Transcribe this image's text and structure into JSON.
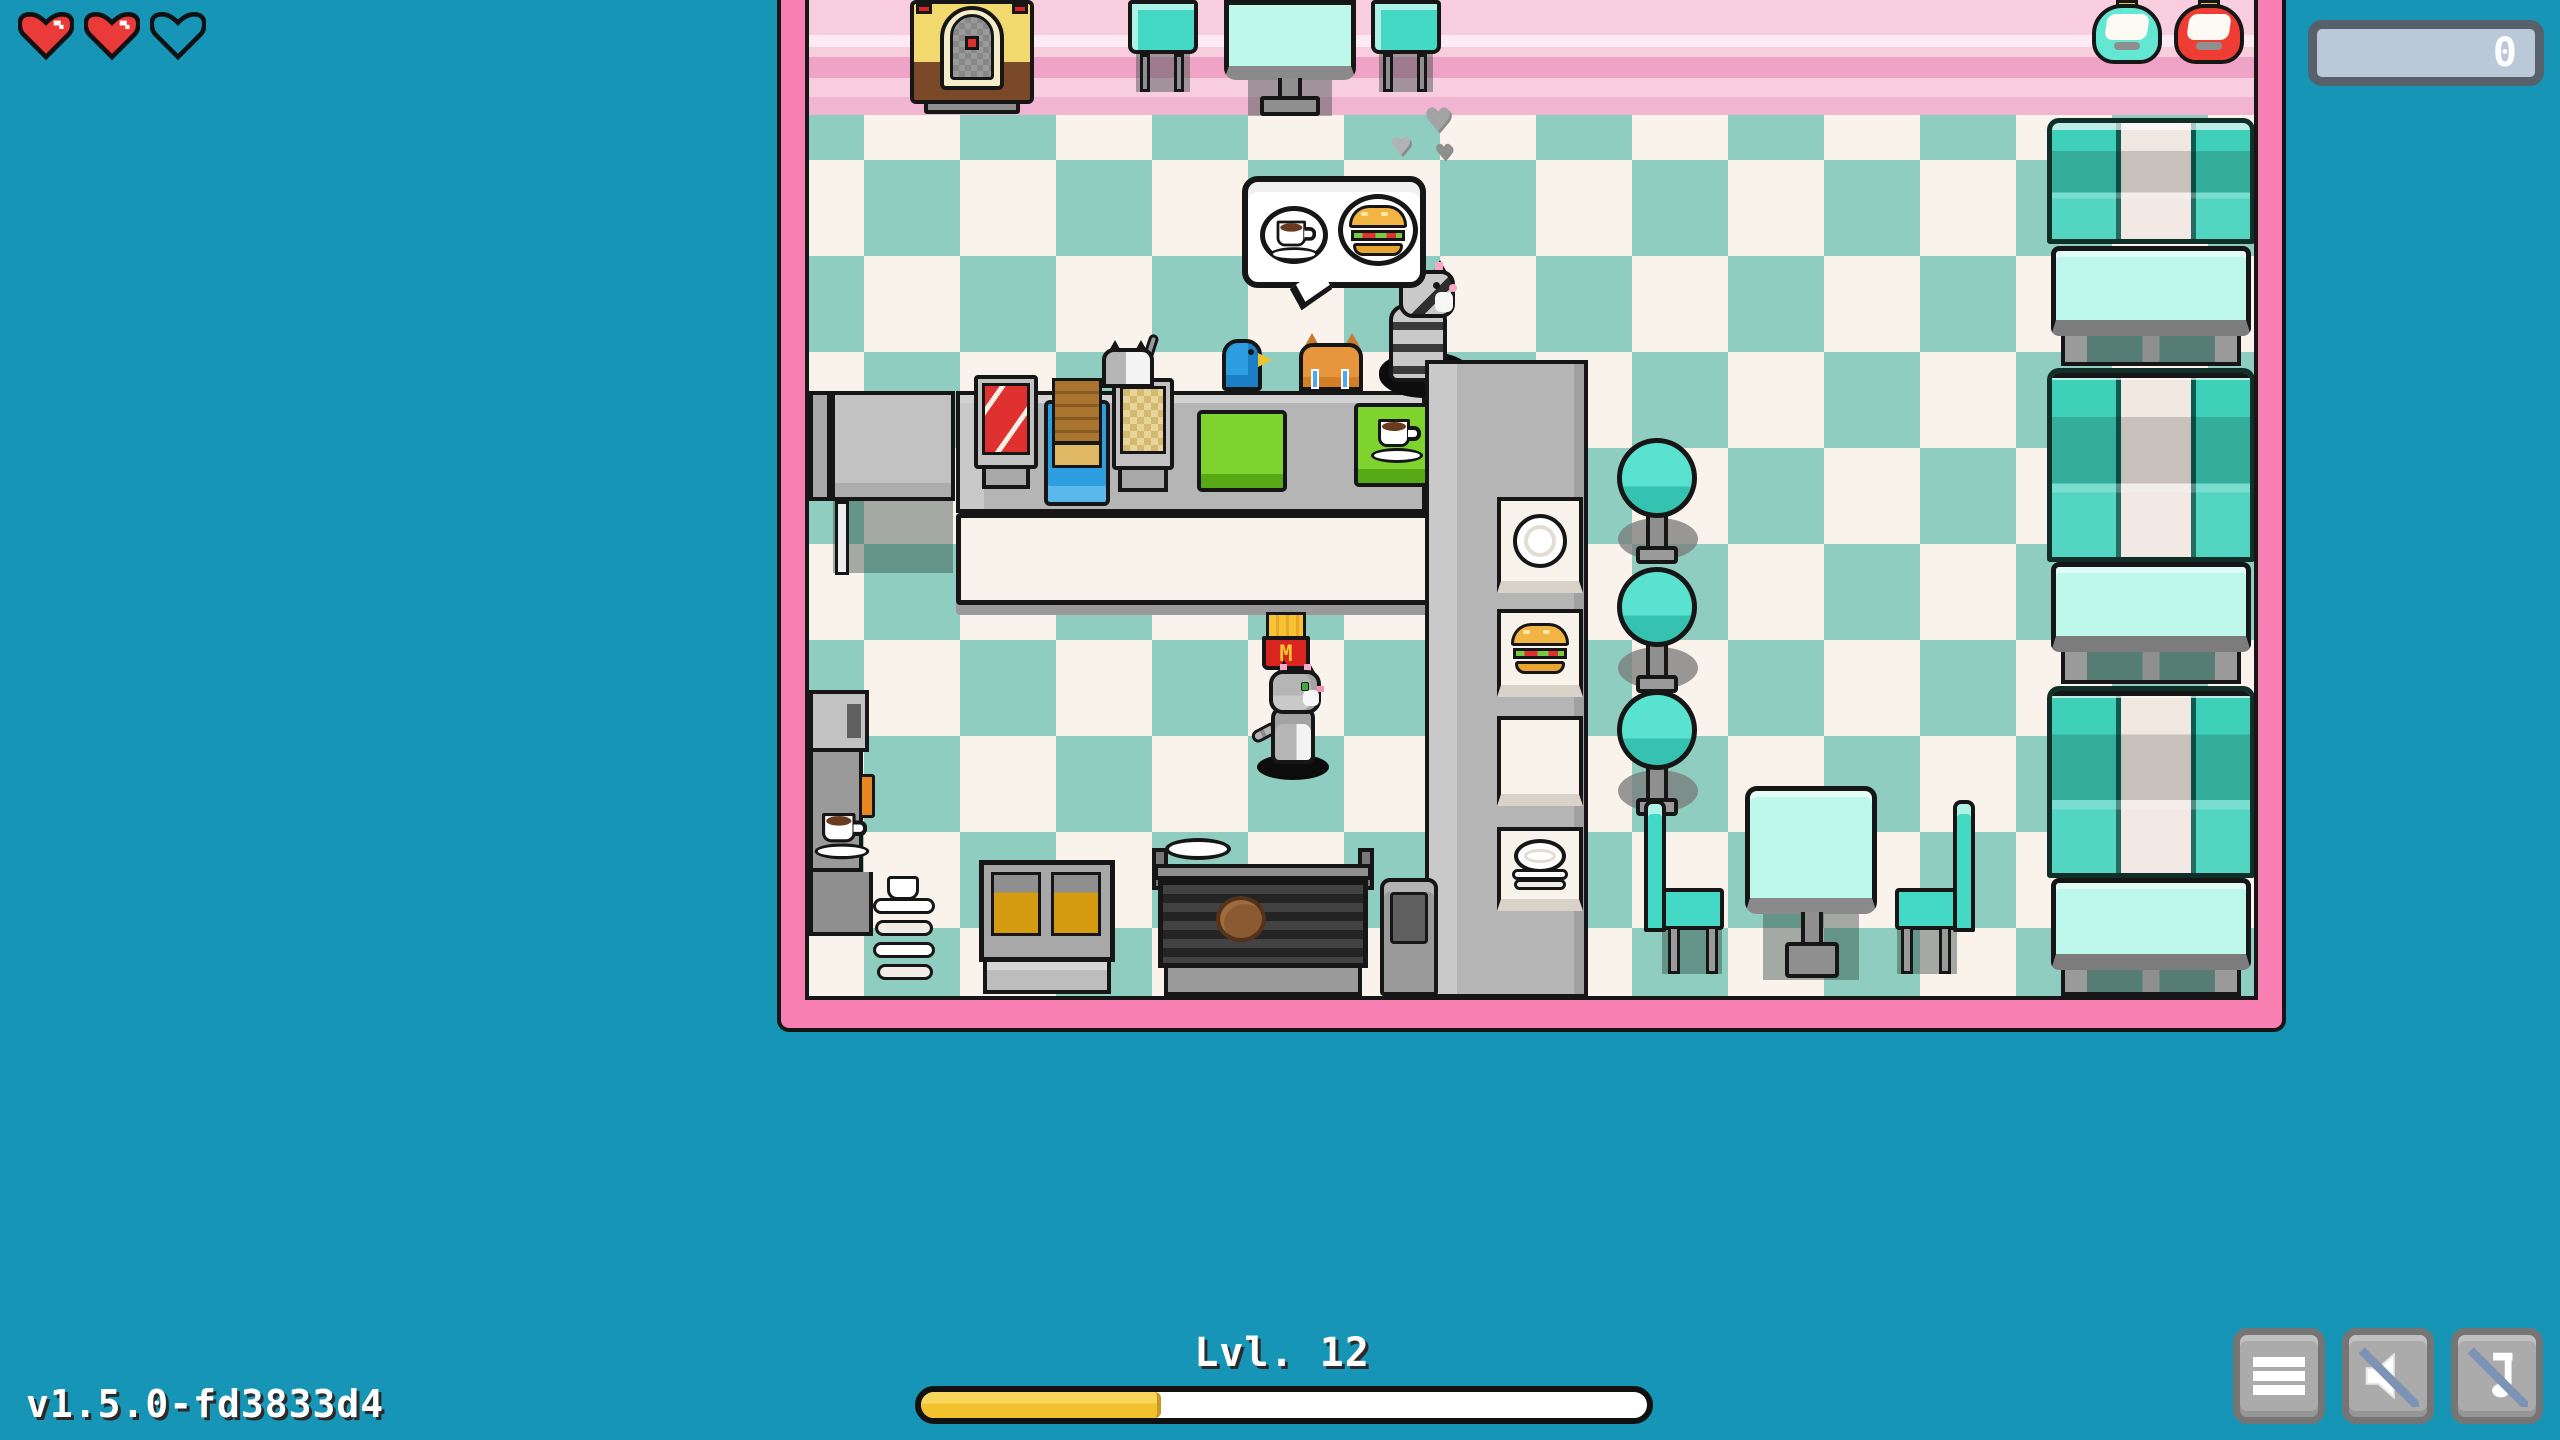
{
  "hud": {
    "hearts": {
      "total": 3,
      "filled": 2,
      "icons": [
        "heart-filled-icon",
        "heart-filled-icon",
        "heart-empty-icon"
      ]
    },
    "coin_counter": {
      "value": "0"
    },
    "level": {
      "label": "Lvl. 12",
      "progress_percent": 33
    },
    "version": "v1.5.0-fd3833d4",
    "controls": [
      {
        "name": "menu-button",
        "icon": "hamburger-icon"
      },
      {
        "name": "sound-muted-button",
        "icon": "speaker-muted-icon"
      },
      {
        "name": "music-muted-button",
        "icon": "music-note-muted-icon"
      }
    ]
  },
  "scene": {
    "room": "retro diner cafe with pink walls and teal checkered floor",
    "speech_bubble": {
      "owner": "customer-cat-gray-striped",
      "items": [
        "coffee-icon",
        "burger-icon"
      ]
    },
    "fries_logo": "M",
    "characters": [
      {
        "name": "player-cat-gray-tabby",
        "state": "standing on floor facing right"
      },
      {
        "name": "customer-cat-gray-striped",
        "state": "waiting at counter under speech bubble, steaming"
      },
      {
        "name": "customer-cat-white-gray",
        "state": "behind counter"
      },
      {
        "name": "customer-bird-blue",
        "state": "behind counter"
      },
      {
        "name": "customer-cat-orange-crying",
        "state": "behind counter, blue tears"
      }
    ],
    "objects": [
      "jukebox",
      "top-dining-table",
      "top-chairs",
      "soda-dispenser-teal",
      "soda-dispenser-red",
      "diner-booth-bench",
      "booth-table",
      "bar-stools",
      "service-counter",
      "service-window-plate",
      "service-window-burger",
      "service-window-empty",
      "service-window-plate-stack",
      "bacon-box",
      "toast-stack-tray",
      "hashbrown-stand",
      "green-placemat",
      "green-placemat-coffee",
      "coffee-machine",
      "saucer-stack",
      "deep-fryer",
      "grill",
      "burger-patty",
      "trash-can",
      "fries-pickup",
      "floor-plate",
      "cafe-table",
      "cafe-chairs",
      "speech-bubble",
      "smoke-puffs"
    ]
  },
  "colors": {
    "bg": "#1695b6",
    "frame-pink": "#f87fb2",
    "wall-pink": "#f8cede",
    "wall-stripe-dark": "#efa3c6",
    "wall-stripe-light": "#fdeaf2",
    "floor-cream": "#faf3ec",
    "floor-teal": "#8ecdc0",
    "booth-teal": "#3fd0ba",
    "booth-cream": "#f0e7e1",
    "table-mint": "#bdf8ea",
    "stool-teal": "#5ae2d1",
    "chair-teal": "#43d9c4",
    "counter-gray": "#b5b5b5",
    "counter-front": "#f7f2ea",
    "gold": "#f2c12e",
    "gold-light": "#f8d75a",
    "heart-red": "#ea3a3a",
    "button-gray": "#ababab",
    "slash-blue": "#7d93b5",
    "coin-panel": "#bac8d8",
    "coin-border": "#57616b",
    "green-mat": "#7ed32f",
    "red-accent": "#e03131",
    "blue-accent": "#2d9fe0"
  }
}
